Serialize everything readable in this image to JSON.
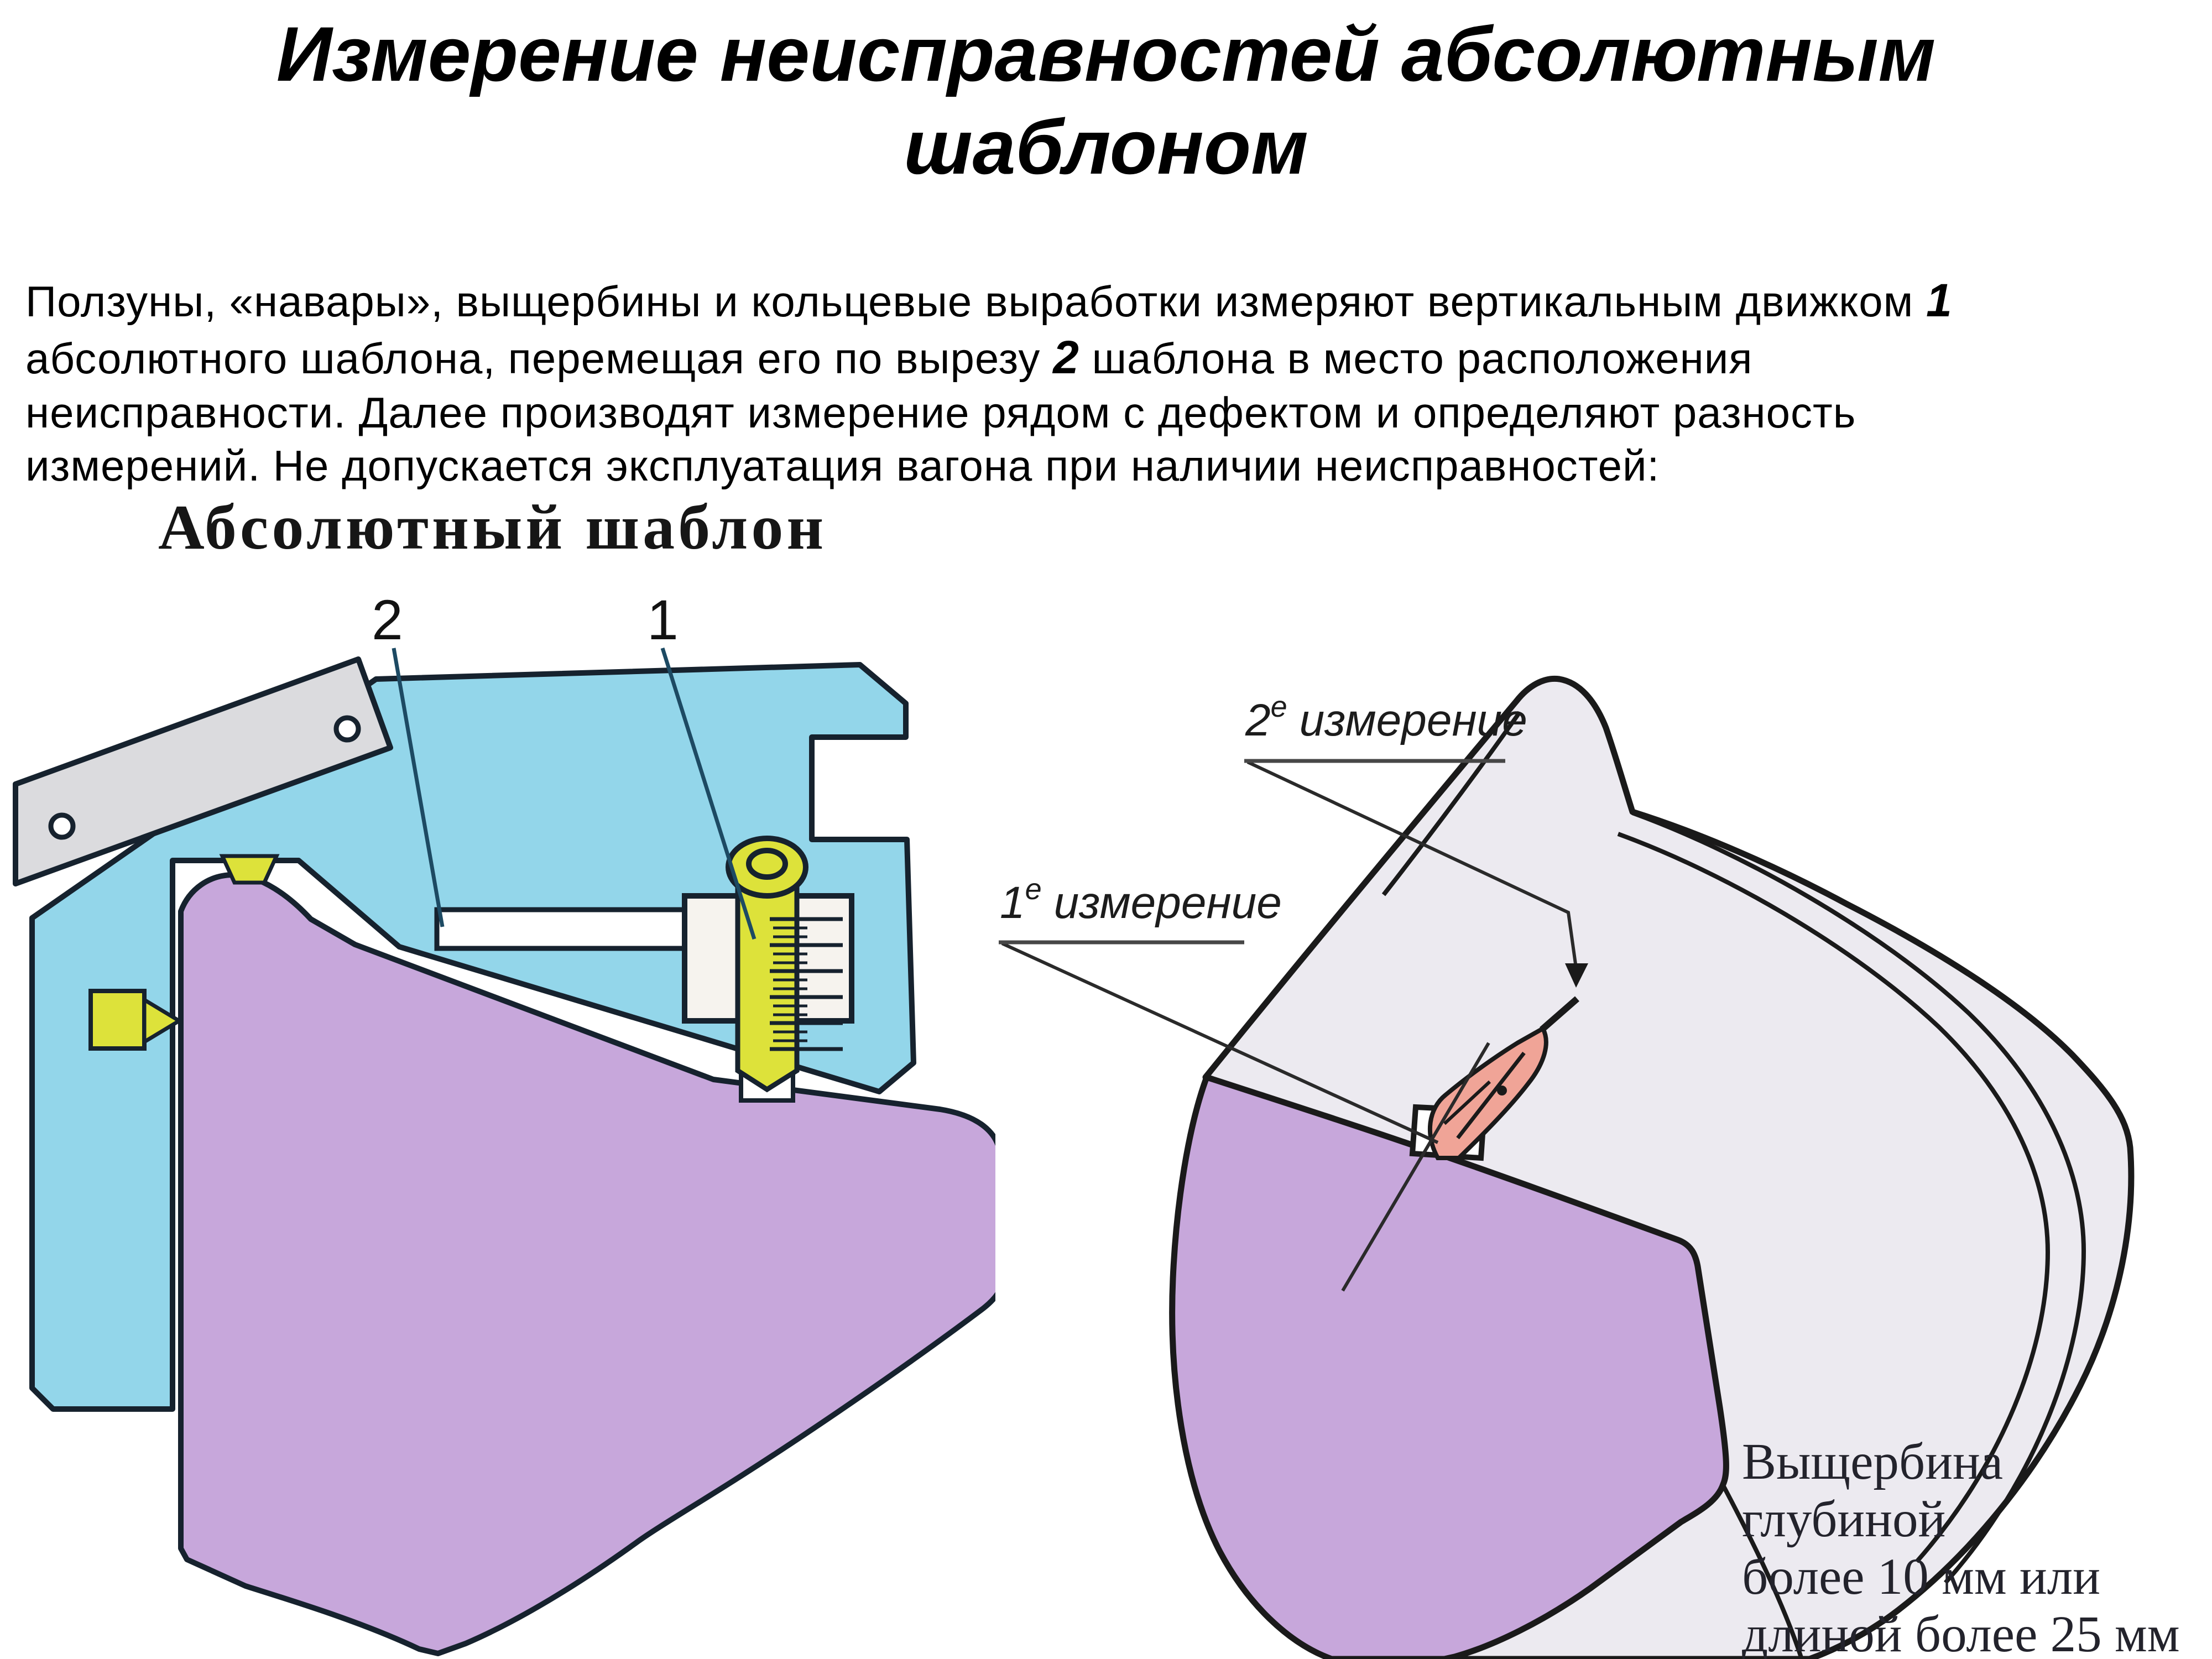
{
  "title": {
    "line1": "Измерение неисправностей абсолютным",
    "line2": "шаблоном"
  },
  "paragraph": {
    "lines": [
      {
        "pre": "Ползуны, «навары», выщербины и кольцевые выработки измеряют вертикальным движком ",
        "bold": "1",
        "post": ""
      },
      {
        "pre": "абсолютного шаблона, перемещая его по вырезу ",
        "bold": "2",
        "post": " шаблона в место расположения"
      },
      {
        "pre": "неисправности. Далее производят измерение рядом с дефектом и определяют разность",
        "bold": "",
        "post": ""
      },
      {
        "pre": "измерений. Не допускается эксплуатация вагона при наличии неисправностей:",
        "bold": "",
        "post": ""
      }
    ]
  },
  "left_figure": {
    "heading": "Абсолютный шаблон",
    "callout_1": "1",
    "callout_2": "2"
  },
  "right_figure": {
    "label_1_num": "1",
    "label_1_sup": "е",
    "label_1_word": "измерение",
    "label_2_num": "2",
    "label_2_sup": "е",
    "label_2_word": "измерение",
    "caption_line1": "Выщербина глубиной",
    "caption_line2": "более 10 мм или",
    "caption_line3": "длиной более 25 мм"
  },
  "colors": {
    "template_blue": "#93d6ea",
    "wheel_purple": "#c7a7db",
    "slider_yellow": "#dde23a",
    "plate_gray": "#dbdbde",
    "housing_white": "#f6f3ee",
    "wheel3d_gray": "#eceaf0",
    "defect_pink": "#f0a497",
    "outline_dark": "#16222e",
    "callout_line_blue": "#1d4a63"
  }
}
